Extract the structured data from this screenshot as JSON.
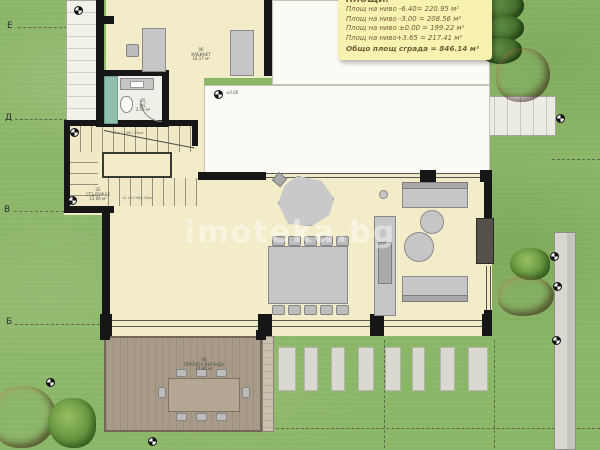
{
  "info_box": {
    "title": "ПЛОЩИ:",
    "lines": [
      "Площ на ниво -6.40= 220.95 м²",
      "Площ на ниво -3.00 = 208.56 м²",
      "Площ на ниво ±0.00 = 199.22 м²",
      "Площ на ниво+3.65 = 217.41 м²"
    ],
    "total": "Общо площ сграда = 846.14 м²"
  },
  "grid": {
    "labels": [
      "Е",
      "Д",
      "В",
      "Б"
    ]
  },
  "rooms": {
    "office": {
      "number": "06",
      "name": "КАБИНЕТ",
      "area": "16.17 м²"
    },
    "wc": {
      "number": "05",
      "name": "WC",
      "area": "3.56 м²"
    },
    "stairs": {
      "number": "02",
      "name": "СТЪЛБИЩЕ",
      "area": "12.06 м²"
    },
    "veranda": {
      "number": "08",
      "name": "ПОКРИТА ВЕРАНДА",
      "area": "27.86 м²"
    }
  },
  "stair_dims": {
    "top": "16 x 17.86 / 28см",
    "bottom": "14 x 17.86 / 28см"
  },
  "levels": {
    "badge": "±0.00"
  },
  "watermark": "imoteka.bg",
  "colors": {
    "grass": "#8db869",
    "floor_cream": "#f2ecc8",
    "wall": "#161616",
    "info_box_bg": "#f8f2b0",
    "deck": "#a79b87",
    "tree_red": "#7c3224",
    "wc_teal": "#8fc0ae"
  }
}
